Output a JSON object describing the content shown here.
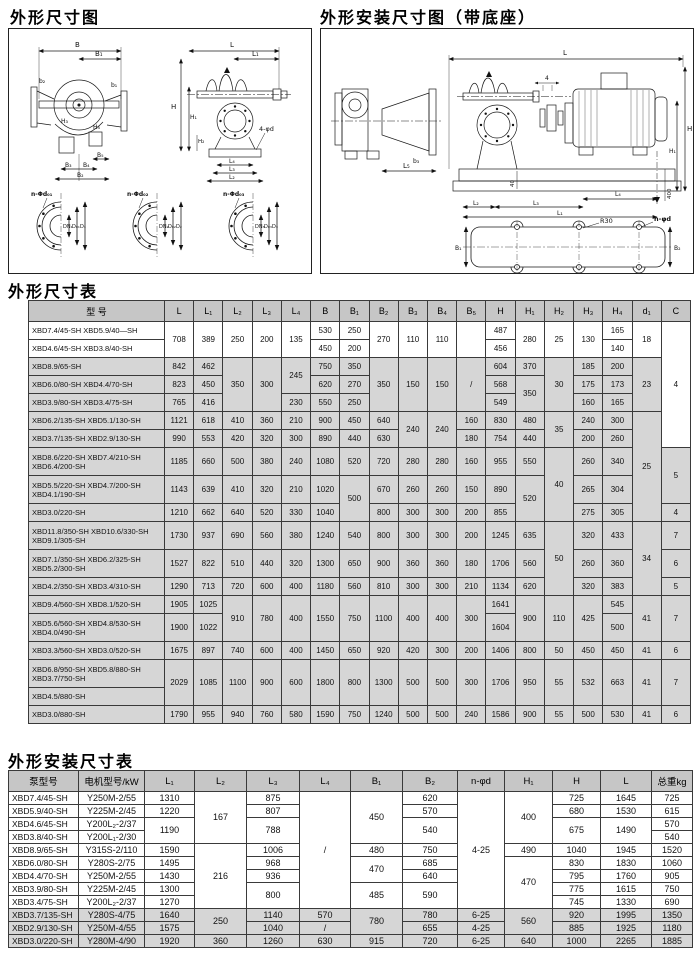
{
  "diagrams": {
    "left": {
      "title": "外形尺寸图",
      "labels": {
        "B": "B",
        "B1": "B₁",
        "b2": "b₂",
        "b1": "b₁",
        "H3": "H₃",
        "H4": "H₄",
        "B5": "B₅",
        "B3": "B₃",
        "B4": "B₄",
        "B2": "B₂",
        "L": "L",
        "L1": "L₁",
        "H": "H",
        "H1": "H₁",
        "H2": "H₂",
        "d4": "4-φd",
        "L4": "L₄",
        "L3": "L₃",
        "L2": "L₂"
      },
      "flanges": [
        {
          "leader": "n-Φd₀₁",
          "dims": [
            "DN₁",
            "D₀₁",
            "D₁"
          ]
        },
        {
          "leader": "n-Φd₀₂",
          "dims": [
            "DN₂",
            "D₀₂",
            "D₂"
          ]
        },
        {
          "leader": "n-Φd₀₃",
          "dims": [
            "DN₃",
            "D₀₃",
            "D₃"
          ]
        }
      ]
    },
    "right": {
      "title": "外形安装尺寸图（带底座）",
      "labels": {
        "L": "L",
        "four": "4",
        "H": "H",
        "H1": "H₁",
        "L5": "L₅",
        "b3": "b₃",
        "forty": "40",
        "fourhundred": "400",
        "L2": "L₂",
        "L3": "L₃",
        "L4": "L₄",
        "L1": "L₁",
        "R30": "R30",
        "nphid": "n-φd",
        "B1": "B₁",
        "B2": "B₂"
      }
    }
  },
  "table1": {
    "title": "外形尺寸表",
    "header": [
      "型  号",
      "L",
      "L₁",
      "L₂",
      "L₃",
      "L₄",
      "B",
      "B₁",
      "B₂",
      "B₃",
      "B₄",
      "B₅",
      "H",
      "H₁",
      "H₂",
      "H₃",
      "H₄",
      "d₁",
      "C"
    ],
    "rows": [
      [
        "XBD7.4/45-SH  XBD5.9/40—SH",
        {
          "t": "708",
          "rs": 2
        },
        {
          "t": "389",
          "rs": 2
        },
        {
          "t": "250",
          "rs": 2
        },
        {
          "t": "200",
          "rs": 2
        },
        {
          "t": "135",
          "rs": 2
        },
        "530",
        "250",
        {
          "t": "270",
          "rs": 2
        },
        {
          "t": "110",
          "rs": 2
        },
        {
          "t": "110",
          "rs": 2
        },
        {
          "t": "",
          "rs": 2
        },
        "487",
        {
          "t": "280",
          "rs": 2
        },
        {
          "t": "25",
          "rs": 2
        },
        {
          "t": "130",
          "rs": 2
        },
        "165",
        {
          "t": "18",
          "rs": 2
        },
        {
          "t": "4",
          "rs": 7
        }
      ],
      [
        "XBD4.6/45-SH  XBD3.8/40-SH",
        "450",
        "200",
        "456",
        "140"
      ],
      [
        "XBD8.9/65-SH",
        "842",
        "462",
        {
          "t": "350",
          "rs": 3
        },
        {
          "t": "300",
          "rs": 3
        },
        {
          "t": "245",
          "rs": 2
        },
        "750",
        "350",
        {
          "t": "350",
          "rs": 3
        },
        {
          "t": "150",
          "rs": 3
        },
        {
          "t": "150",
          "rs": 3
        },
        {
          "t": "/",
          "rs": 3
        },
        "604",
        "370",
        {
          "t": "30",
          "rs": 3
        },
        "185",
        "200",
        {
          "t": "23",
          "rs": 3
        }
      ],
      [
        "XBD6.0/80-SH  XBD4.4/70-SH",
        "823",
        "450",
        "620",
        "270",
        "568",
        {
          "t": "350",
          "rs": 2
        },
        "175",
        "173"
      ],
      [
        "XBD3.9/80-SH  XBD3.4/75-SH",
        "765",
        "416",
        "230",
        "550",
        "250",
        "549",
        "160",
        "165"
      ],
      [
        "XBD6.2/135-SH XBD5.1/130-SH",
        "1121",
        "618",
        "410",
        "360",
        "210",
        "900",
        "450",
        "640",
        {
          "t": "240",
          "rs": 2
        },
        {
          "t": "240",
          "rs": 2
        },
        "160",
        "830",
        "480",
        {
          "t": "35",
          "rs": 2
        },
        "240",
        "300",
        {
          "t": "25",
          "rs": 5
        }
      ],
      [
        "XBD3.7/135-SH XBD2.9/130-SH",
        "990",
        "553",
        "420",
        "320",
        "300",
        "890",
        "440",
        "630",
        "180",
        "754",
        "440",
        "200",
        "260"
      ],
      [
        "XBD8.6/220-SH XBD7.4/210-SH\nXBD6.4/200-SH",
        "1185",
        "660",
        "500",
        "380",
        "240",
        "1080",
        "520",
        "720",
        "280",
        "280",
        "160",
        "955",
        "550",
        {
          "t": "40",
          "rs": 3
        },
        "260",
        "340",
        {
          "t": "5",
          "rs": 2
        }
      ],
      [
        "XBD5.5/220-SH XBD4.7/200-SH\nXBD4.1/190-SH",
        "1143",
        "639",
        "410",
        "320",
        "210",
        "1020",
        {
          "t": "500",
          "rs": 2
        },
        "670",
        "260",
        "260",
        "150",
        "890",
        {
          "t": "520",
          "rs": 2
        },
        "265",
        "304"
      ],
      [
        "XBD3.0/220-SH",
        "1210",
        "662",
        "640",
        "520",
        "330",
        "1040",
        "800",
        "300",
        "300",
        "200",
        "855",
        "275",
        "305",
        "4"
      ],
      [
        "XBD11.8/350-SH XBD10.6/330-SH\nXBD9.1/305-SH",
        "1730",
        "937",
        "690",
        "560",
        "380",
        "1240",
        "540",
        "800",
        "300",
        "300",
        "200",
        "1245",
        "635",
        {
          "t": "50",
          "rs": 3
        },
        "320",
        "433",
        {
          "t": "34",
          "rs": 3
        },
        "7"
      ],
      [
        "XBD7.1/350-SH XBD6.2/325-SH\nXBD5.2/300-SH",
        "1527",
        "822",
        "510",
        "440",
        "320",
        "1300",
        "650",
        "900",
        "360",
        "360",
        "180",
        "1706",
        "560",
        "260",
        "360",
        "6"
      ],
      [
        "XBD4.2/350-SH XBD3.4/310-SH",
        "1290",
        "713",
        "720",
        "600",
        "400",
        "1180",
        "560",
        "810",
        "300",
        "300",
        "210",
        "1134",
        "620",
        "320",
        "383",
        "5"
      ],
      [
        "XBD9.4/560-SH XBD8.1/520-SH",
        "1905",
        "1025",
        {
          "t": "910",
          "rs": 2
        },
        {
          "t": "780",
          "rs": 2
        },
        {
          "t": "400",
          "rs": 2
        },
        {
          "t": "1550",
          "rs": 2
        },
        {
          "t": "750",
          "rs": 2
        },
        {
          "t": "1100",
          "rs": 2
        },
        {
          "t": "400",
          "rs": 2
        },
        {
          "t": "400",
          "rs": 2
        },
        {
          "t": "300",
          "rs": 2
        },
        "1641",
        {
          "t": "900",
          "rs": 2
        },
        {
          "t": "110",
          "rs": 2
        },
        {
          "t": "425",
          "rs": 2
        },
        "545",
        {
          "t": "41",
          "rs": 2
        },
        {
          "t": "7",
          "rs": 2
        }
      ],
      [
        "XBD5.6/560-SH XBD4.8/530-SH\nXBD4.0/490-SH",
        "1900",
        "1022",
        "1604",
        "500"
      ],
      [
        "XBD3.3/560-SH XBD3.0/520-SH",
        "1675",
        "897",
        "740",
        "600",
        "400",
        "1450",
        "650",
        "920",
        "420",
        "300",
        "200",
        "1406",
        "800",
        "50",
        "450",
        "450",
        "41",
        "6"
      ],
      [
        "XBD6.8/950-SH XBD5.8/880-SH\nXBD3.7/750-SH",
        {
          "t": "2029",
          "rs": 2
        },
        {
          "t": "1085",
          "rs": 2
        },
        {
          "t": "1100",
          "rs": 2
        },
        {
          "t": "900",
          "rs": 2
        },
        {
          "t": "600",
          "rs": 2
        },
        {
          "t": "1800",
          "rs": 2
        },
        {
          "t": "800",
          "rs": 2
        },
        {
          "t": "1300",
          "rs": 2
        },
        {
          "t": "500",
          "rs": 2
        },
        {
          "t": "500",
          "rs": 2
        },
        {
          "t": "300",
          "rs": 2
        },
        {
          "t": "1706",
          "rs": 2
        },
        {
          "t": "950",
          "rs": 2
        },
        {
          "t": "55",
          "rs": 2
        },
        {
          "t": "532",
          "rs": 2
        },
        {
          "t": "663",
          "rs": 2
        },
        {
          "t": "41",
          "rs": 2
        },
        {
          "t": "7",
          "rs": 2
        }
      ],
      [
        "XBD4.5/880-SH"
      ],
      [
        "XBD3.0/880-SH",
        "1790",
        "955",
        "940",
        "760",
        "580",
        "1590",
        "750",
        "1240",
        "500",
        "500",
        "240",
        "1586",
        "900",
        "55",
        "500",
        "530",
        "41",
        "6"
      ]
    ]
  },
  "table2": {
    "title": "外形安装尺寸表",
    "header": [
      "泵型号",
      "电机型号/kW",
      "L₁",
      "L₂",
      "L₃",
      "L₄",
      "B₁",
      "B₂",
      "n-φd",
      "H₁",
      "H",
      "L",
      "总重kg"
    ],
    "rows": [
      [
        "XBD7.4/45-SH",
        "Y250M-2/55",
        "1310",
        {
          "t": "167",
          "rs": 4
        },
        "875",
        {
          "t": "/",
          "rs": 9
        },
        {
          "t": "450",
          "rs": 4
        },
        "620",
        {
          "t": "4-25",
          "rs": 9
        },
        {
          "t": "400",
          "rs": 4
        },
        "725",
        "1645",
        "725"
      ],
      [
        "XBD5.9/40-SH",
        "Y225M-2/45",
        "1220",
        "807",
        "570",
        "680",
        "1530",
        "615"
      ],
      [
        "XBD4.6/45-SH",
        "Y200L₂-2/37",
        {
          "t": "1190",
          "rs": 2
        },
        {
          "t": "788",
          "rs": 2
        },
        {
          "t": "540",
          "rs": 2
        },
        {
          "t": "675",
          "rs": 2
        },
        {
          "t": "1490",
          "rs": 2
        },
        "570"
      ],
      [
        "XBD3.8/40-SH",
        "Y200L₁-2/30",
        "540"
      ],
      [
        "XBD8.9/65-SH",
        "Y315S-2/110",
        "1590",
        {
          "t": "216",
          "rs": 5
        },
        "1006",
        "480",
        "750",
        "490",
        "1040",
        "1945",
        "1520"
      ],
      [
        "XBD6.0/80-SH",
        "Y280S-2/75",
        "1495",
        "968",
        {
          "t": "470",
          "rs": 2
        },
        "685",
        {
          "t": "470",
          "rs": 4
        },
        "830",
        "1830",
        "1060"
      ],
      [
        "XBD4.4/70-SH",
        "Y250M-2/55",
        "1430",
        "936",
        "640",
        "795",
        "1760",
        "905"
      ],
      [
        "XBD3.9/80-SH",
        "Y225M-2/45",
        "1300",
        {
          "t": "800",
          "rs": 2
        },
        {
          "t": "485",
          "rs": 2
        },
        {
          "t": "590",
          "rs": 2
        },
        "775",
        "1615",
        "750"
      ],
      [
        "XBD3.4/75-SH",
        "Y200L₂-2/37",
        "1270",
        "745",
        "1330",
        "690"
      ],
      [
        "XBD3.7/135-SH",
        "Y280S-4/75",
        "1640",
        {
          "t": "250",
          "rs": 2
        },
        "1140",
        "570",
        {
          "t": "780",
          "rs": 2
        },
        "780",
        "6-25",
        {
          "t": "560",
          "rs": 2
        },
        "920",
        "1995",
        "1350"
      ],
      [
        "XBD2.9/130-SH",
        "Y250M-4/55",
        "1575",
        "1040",
        "/",
        "655",
        "4-25",
        "885",
        "1925",
        "1180"
      ],
      [
        "XBD3.0/220-SH",
        "Y280M-4/90",
        "1920",
        "360",
        "1260",
        "630",
        "915",
        "720",
        "6-25",
        "640",
        "1000",
        "2265",
        "1885"
      ]
    ]
  }
}
